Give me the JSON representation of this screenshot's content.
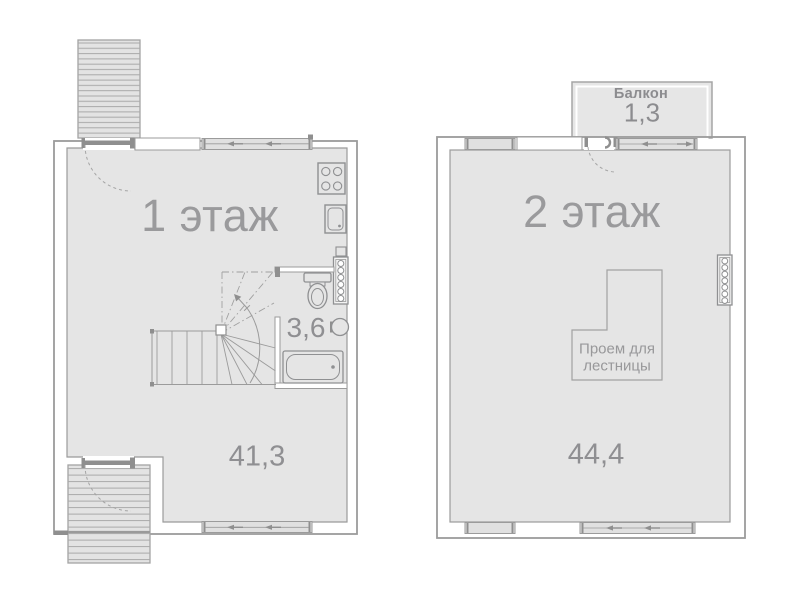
{
  "plan": {
    "floor1": {
      "title": "1 этаж",
      "area": "41,3",
      "bathroom_area": "3,6"
    },
    "floor2": {
      "title": "2 этаж",
      "area": "44,4",
      "stair_opening_label": "Проем для лестницы",
      "balcony": {
        "label": "Балкон",
        "area": "1,3"
      }
    },
    "colors": {
      "room_fill": "#e5e5e5",
      "stair_fill": "#e3e3e3",
      "wall_line": "#9b9b9b",
      "fixture_line": "#8f9092",
      "label_text": "#9a9a9c"
    }
  }
}
